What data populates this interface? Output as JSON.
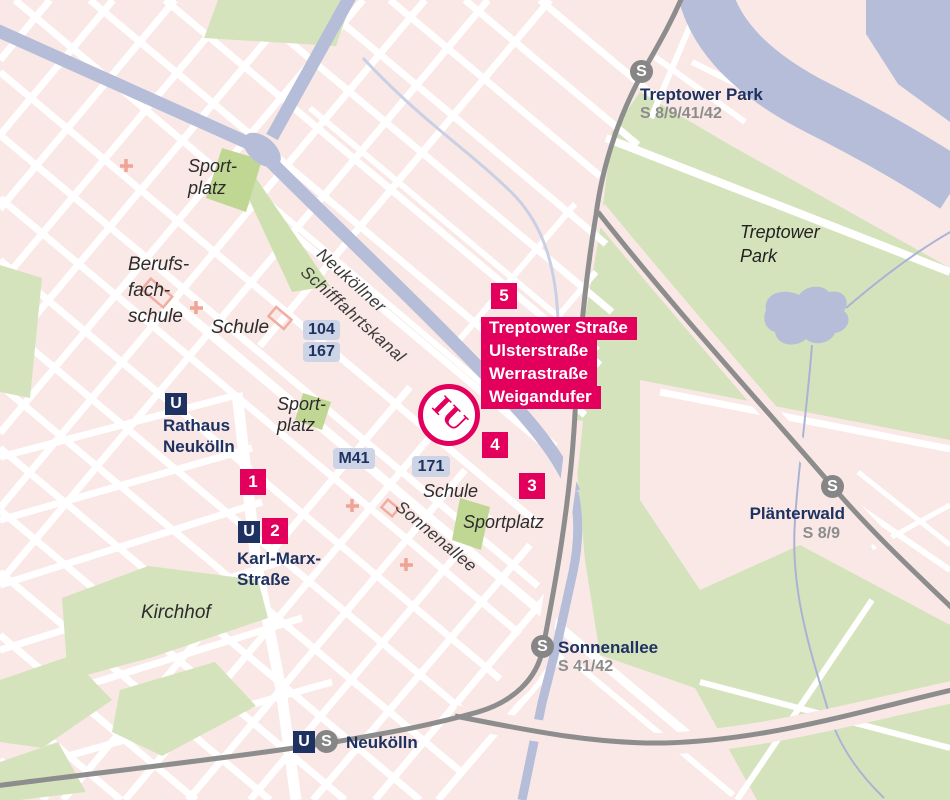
{
  "colors": {
    "background_pink": "#f9e8e6",
    "street_white": "#ffffff",
    "park_green": "#d5e3bc",
    "sport_green": "#c0d794",
    "water_blue": "#b5bdd8",
    "rail_gray": "#8d8d8d",
    "brand_pink": "#e2005c",
    "navy": "#1e3261",
    "bus_badge_bg": "#ccd4e6",
    "muted_text": "#8c8c8c"
  },
  "campus": {
    "logo_text": "IU",
    "marker_numbers": [
      "1",
      "2",
      "3",
      "4",
      "5"
    ],
    "address_box": {
      "lines": [
        "Treptower Straße",
        "Ulsterstraße",
        "Werrastraße",
        "Weigandufer"
      ]
    }
  },
  "stations": {
    "treptower_park": {
      "badge": "S",
      "name": "Treptower Park",
      "lines": "S 8/9/41/42"
    },
    "plaenterwald": {
      "badge": "S",
      "name": "Plänterwald",
      "lines": "S 8/9"
    },
    "sonnenallee": {
      "badge": "S",
      "name": "Sonnenallee",
      "lines": "S 41/42"
    },
    "neukoelln": {
      "badge_u": "U",
      "badge_s": "S",
      "name": "Neukölln"
    },
    "rathaus_neukoelln": {
      "badge": "U",
      "name_line1": "Rathaus",
      "name_line2": "Neukölln"
    },
    "karl_marx_strasse": {
      "badge": "U",
      "name_line1": "Karl-Marx-",
      "name_line2": "Straße"
    }
  },
  "bus_stops": {
    "routes_104_167": [
      "104",
      "167"
    ],
    "route_m41": "M41",
    "route_171": "171"
  },
  "places": {
    "sportplatz_north": {
      "line1": "Sport-",
      "line2": "platz"
    },
    "berufsfachschule": {
      "line1": "Berufs-",
      "line2": "fach-",
      "line3": "schule"
    },
    "schule_west": "Schule",
    "sportplatz_mid": {
      "line1": "Sport-",
      "line2": "platz"
    },
    "schule_south": "Schule",
    "sportplatz_southeast": "Sportplatz",
    "kirchhof": "Kirchhof",
    "treptower_park_label": {
      "line1": "Treptower",
      "line2": "Park"
    }
  },
  "streets": {
    "sonnenallee": "Sonnenallee",
    "canal_line1": "Neuköllner",
    "canal_line2": "Schifffahrtskanal"
  }
}
